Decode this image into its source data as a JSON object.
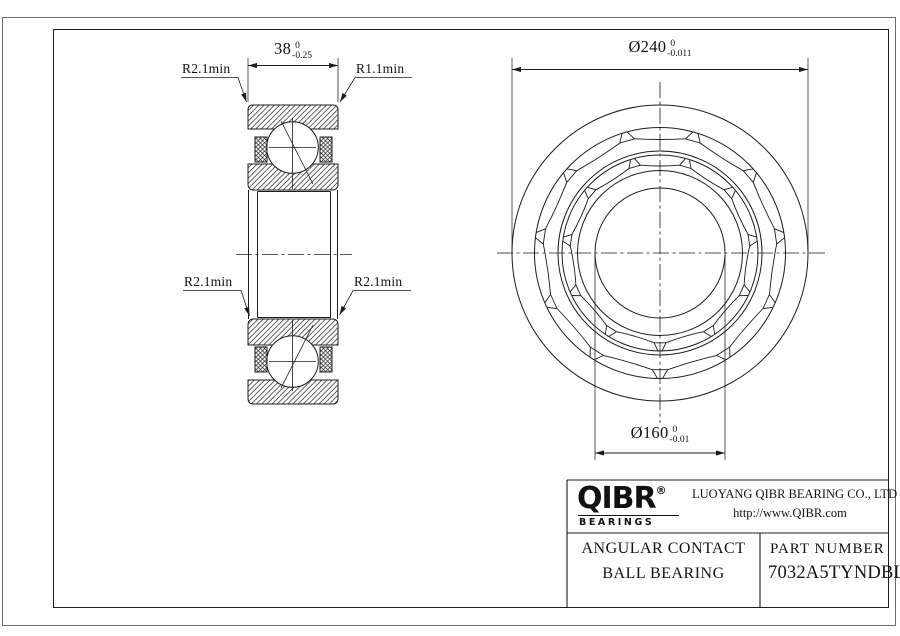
{
  "dimensions": {
    "width": {
      "text": "38",
      "tol_upper": "0",
      "tol_lower": "-0.25"
    },
    "outer_diameter": {
      "text": "Ø240",
      "tol_upper": "0",
      "tol_lower": "-0.011"
    },
    "bore_diameter": {
      "text": "Ø160",
      "tol_upper": "0",
      "tol_lower": "-0.01"
    }
  },
  "labels": {
    "top_left": "R2.1min",
    "top_right": "R1.1min",
    "mid_left": "R2.1min",
    "mid_right": "R2.1min"
  },
  "title_block": {
    "logo_text": "QIBR",
    "logo_reg": "®",
    "logo_sub": "BEARINGS",
    "company": "LUOYANG QIBR BEARING CO., LTD",
    "website": "http://www.QIBR.com",
    "product_line1": "ANGULAR CONTACT",
    "product_line2": "BALL BEARING",
    "part_label": "PART NUMBER",
    "part_number": "7032A5TYNDBLP4"
  },
  "colors": {
    "line": "#1c1c1c",
    "background": "#ffffff"
  }
}
